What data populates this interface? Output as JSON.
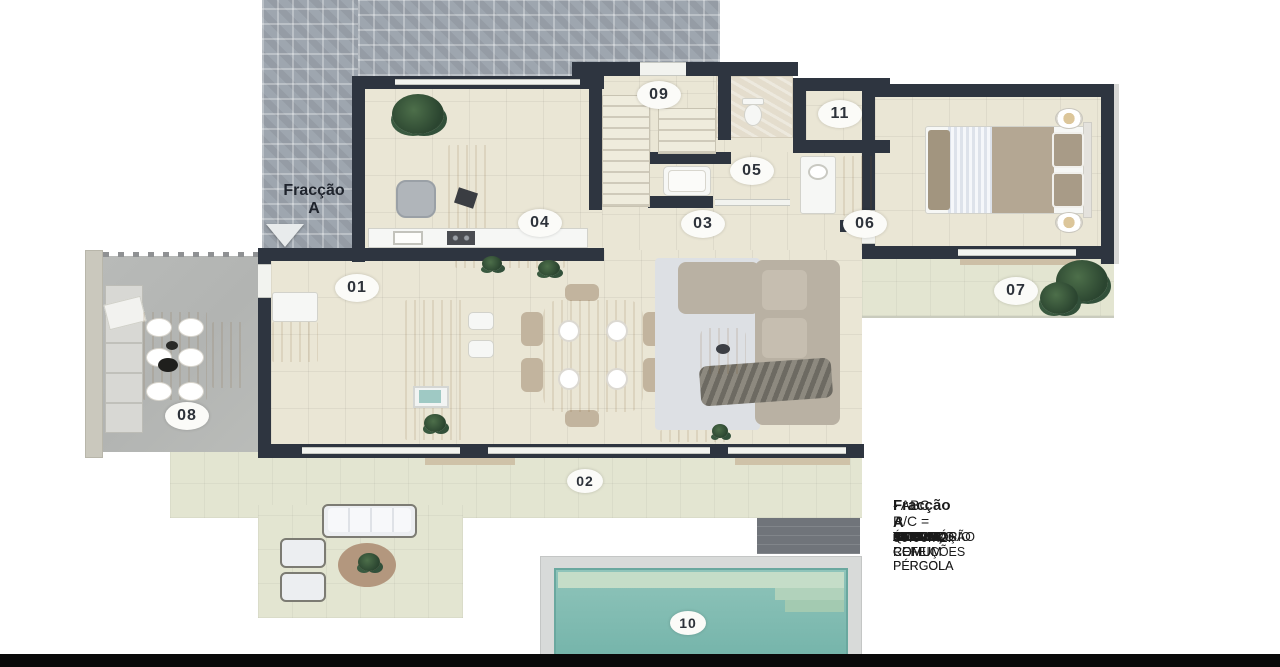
{
  "plan": {
    "entrance_label": {
      "line1": "Fracção",
      "line2": "A"
    },
    "room_labels": {
      "r01": "01",
      "r02": "02",
      "r03": "03",
      "r04": "04",
      "r05": "05",
      "r06": "06",
      "r07": "07",
      "r08": "08",
      "r09": "09",
      "r10": "10",
      "r11": "11"
    }
  },
  "legend": {
    "heading_name": "Fracção A",
    "heading_detail": "- ABC R/C = 80.00m2:",
    "unit": "m2",
    "rows": [
      {
        "num": "01",
        "name": "SALA COMUM",
        "area": "31.20"
      },
      {
        "num": "02",
        "name": "TERRAÇO COM PÉRGOLA",
        "area": "7.70"
      },
      {
        "num": "03",
        "name": "CIRCULAÇÃO",
        "area": "3.20"
      },
      {
        "num": "04",
        "name": "ESCRITÓRIO",
        "area": "9.50"
      },
      {
        "num": "05",
        "name": "I.S. COMUM",
        "area": "3.55"
      },
      {
        "num": "06",
        "name": "QUARTO",
        "area": "11.55"
      },
      {
        "num": "07",
        "name": "TERRAÇO COM PÉRGOLA",
        "area": "4.20"
      },
      {
        "num": "08",
        "name": "ÁREA REFEIÇÕES",
        "area": "25.00"
      },
      {
        "num": "09",
        "name": "ARRUMOS",
        "area": "2.35"
      }
    ]
  },
  "colors": {
    "wall": "#2e3540",
    "interior_floor": "#eae6d5",
    "terrace": "#e3e5d1",
    "paver": "#9ea6af",
    "concrete": "#b5b7b5",
    "pool_water": "#7abbb1",
    "wood": "#d2a873",
    "label_pill": "#fbfbf8"
  }
}
